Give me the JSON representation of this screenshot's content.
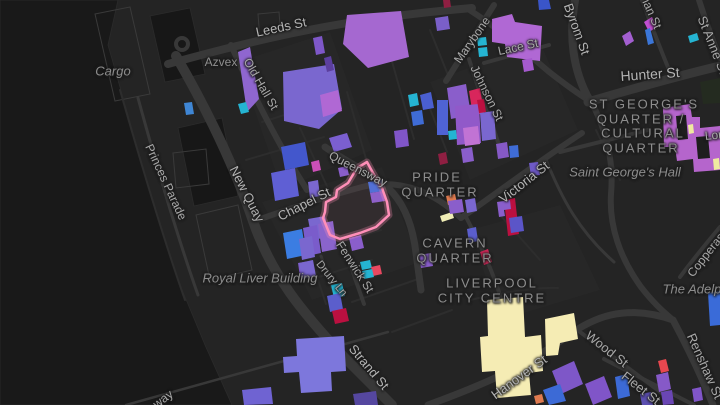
{
  "app": {
    "title": "Liverpool city centre dark map with highlighted parcel"
  },
  "map": {
    "width": 720,
    "height": 405,
    "palette": {
      "land": "#242424",
      "water": "#191919",
      "dock_water": "#171717",
      "block": "#272727",
      "road": "#383838",
      "minor_road": "#2d2d2d",
      "outline": "#3a3a3a",
      "park": "#242b20",
      "highlight_pink": "#ff8fb8",
      "building_purple": "#7a67cf",
      "building_magenta": "#b068d4",
      "building_blue": "#3f6cd6",
      "building_cyan": "#25b4d2",
      "building_crimson": "#bb1040",
      "building_cream": "#f5ecb4",
      "building_orange": "#e07b50"
    },
    "water_shapes": [
      {
        "pts": "0,0 118,0 108,45 128,115 152,200 178,280 205,345 232,405 0,405",
        "fill": "#191919"
      },
      {
        "pts": "178,128 222,118 238,196 194,206",
        "fill": "#171717"
      },
      {
        "pts": "150,16 190,8 205,74 165,82",
        "fill": "#171717"
      }
    ],
    "blocks": [
      {
        "pts": "238,62 330,32 372,150 282,190"
      },
      {
        "pts": "262,202 382,167 420,262 312,300"
      },
      {
        "pts": "430,82 540,42 578,130 470,180"
      },
      {
        "pts": "470,230 560,205 600,290 500,320"
      }
    ],
    "dock_outlines": [
      {
        "pts": "95,14 130,7 150,94 115,101"
      },
      {
        "pts": "196,215 238,205 252,270 210,280"
      },
      {
        "pts": "173,153 206,149 209,184 176,188"
      },
      {
        "pts": "258,14 279,12 281,38 260,40"
      }
    ],
    "roads": [
      {
        "d": "M 176,56 C 206,108 233,162 253,221 C 272,276 302,312 344,357 L 392,405",
        "w": 10
      },
      {
        "d": "M 168,64 C 262,38 342,19 472,8",
        "w": 8
      },
      {
        "d": "M 468,9 C 498,28 526,52 548,71 C 562,82 575,92 590,101",
        "w": 6
      },
      {
        "d": "M 575,0 C 569,34 572,70 590,101",
        "w": 8
      },
      {
        "d": "M 588,102 C 632,89 682,75 720,66",
        "w": 9
      },
      {
        "d": "M 592,103 C 606,131 614,160 611,194 C 609,226 620,258 641,287 C 655,305 664,312 673,320",
        "w": 6
      },
      {
        "d": "M 673,320 C 690,352 703,380 713,405",
        "w": 7
      },
      {
        "d": "M 428,405 C 472,389 522,369 566,337 C 592,318 624,303 673,320",
        "w": 7
      },
      {
        "d": "M 461,218 C 500,191 542,159 582,133",
        "w": 6
      },
      {
        "d": "M 252,222 C 302,204 332,195 362,187 C 402,177 436,194 461,218",
        "w": 6
      },
      {
        "d": "M 325,147 C 356,168 378,176 393,193 C 406,208 413,228 416,253 L 421,290",
        "w": 7
      },
      {
        "d": "M 231,45 C 252,92 272,132 296,172 L 307,190",
        "w": 6
      },
      {
        "d": "M 446,81 L 494,5",
        "w": 6
      },
      {
        "d": "M 469,59 C 477,85 485,108 494,130 L 500,148",
        "w": 4
      },
      {
        "d": "M 484,63 L 549,45",
        "w": 4
      },
      {
        "d": "M 699,0 C 707,25 714,44 720,58",
        "w": 6
      },
      {
        "d": "M 642,0 C 650,22 657,40 665,60 L 670,72",
        "w": 4
      },
      {
        "d": "M 690,146 L 720,128",
        "w": 5
      },
      {
        "d": "M 680,277 C 694,258 706,244 720,227",
        "w": 4
      },
      {
        "d": "M 341,238 L 364,304",
        "w": 4
      },
      {
        "d": "M 321,256 L 341,312",
        "w": 3
      },
      {
        "d": "M 568,323 L 667,397",
        "w": 4
      },
      {
        "d": "M 604,359 L 694,405",
        "w": 4
      },
      {
        "d": "M 466,217 C 482,248 494,274 502,302",
        "w": 4
      },
      {
        "d": "M 560,152 L 648,130",
        "w": 4
      },
      {
        "d": "M 545,157 C 562,200 580,232 614,262",
        "w": 3
      },
      {
        "d": "M 138,98 C 155,160 175,230 198,295",
        "w": 3
      },
      {
        "d": "M 126,405 L 388,332",
        "w": 2.5
      }
    ],
    "minor_roads": [
      {
        "d": "M 262,122 L 332,100"
      },
      {
        "d": "M 246,160 L 324,137"
      },
      {
        "d": "M 300,128 L 332,197"
      },
      {
        "d": "M 347,92 L 372,180"
      },
      {
        "d": "M 391,58 L 414,139"
      },
      {
        "d": "M 425,96 L 447,152"
      },
      {
        "d": "M 302,232 L 326,304"
      },
      {
        "d": "M 309,252 L 381,230"
      },
      {
        "d": "M 303,282 L 372,260"
      },
      {
        "d": "M 352,302 L 421,278"
      },
      {
        "d": "M 392,332 L 452,310"
      },
      {
        "d": "M 500,215 L 540,260"
      },
      {
        "d": "M 596,130 L 620,180"
      },
      {
        "d": "M 430,30 L 450,80"
      },
      {
        "d": "M 120,90 C 140,160 162,235 185,300"
      },
      {
        "d": "M 470,300 C 505,292 535,287 558,288"
      }
    ],
    "roundabouts": [
      {
        "cx": 182,
        "cy": 44,
        "r": 6
      }
    ],
    "park_shapes": [
      {
        "pts": "700,82 720,78 720,103 703,104"
      }
    ],
    "buildings": [
      {
        "pts": "347,15 401,11 409,57 368,68 343,44",
        "fill": "#a568d0"
      },
      {
        "pts": "283,72 334,64 342,109 319,129 284,121",
        "fill": "#7a67cf"
      },
      {
        "pts": "320,95 338,90 342,111 323,117",
        "fill": "#b068d4"
      },
      {
        "pts": "238,52 250,47 259,99 247,112",
        "fill": "#8f66cf"
      },
      {
        "pts": "238,104 246,102 249,112 241,114",
        "fill": "#25b4d2"
      },
      {
        "pts": "313,38 322,36 325,53 316,55",
        "fill": "#7e57c8"
      },
      {
        "pts": "324,58 331,56 334,70 327,72",
        "fill": "#5c3f9e"
      },
      {
        "pts": "411,112 422,110 424,124 413,126",
        "fill": "#3f6cd6"
      },
      {
        "pts": "408,95 417,93 419,105 410,107",
        "fill": "#25b4d2"
      },
      {
        "pts": "184,103 192,102 194,114 186,115",
        "fill": "#3f86d4"
      },
      {
        "pts": "492,19 512,14 515,22 542,26 540,61 507,57 505,44 492,42",
        "fill": "#b068d4"
      },
      {
        "pts": "435,18 448,16 450,29 437,31",
        "fill": "#7a5fc8"
      },
      {
        "pts": "477,38 486,37 487,45 478,46",
        "fill": "#25b4d2"
      },
      {
        "pts": "478,48 487,47 488,56 479,57",
        "fill": "#25b4d2"
      },
      {
        "pts": "522,60 532,58 534,70 524,72",
        "fill": "#a55ace"
      },
      {
        "pts": "538,0 549,0 551,9 539,10",
        "fill": "#3a55c8"
      },
      {
        "pts": "443,0 450,0 451,7 444,8",
        "fill": "#8f1f42"
      },
      {
        "pts": "469,91 480,88 484,113 473,116",
        "fill": "#d8265c"
      },
      {
        "pts": "447,88 466,84 471,115 451,119",
        "fill": "#8a5ecb"
      },
      {
        "pts": "420,95 431,92 434,108 423,110",
        "fill": "#4a5fd0"
      },
      {
        "pts": "644,22 652,17 657,27 649,32",
        "fill": "#c14fd0"
      },
      {
        "pts": "622,36 630,31 634,41 626,46",
        "fill": "#a35fd0"
      },
      {
        "pts": "645,30 650,28 654,43 648,45",
        "fill": "#3b76d8"
      },
      {
        "pts": "688,36 697,33 699,40 690,43",
        "fill": "#25b4d2"
      },
      {
        "pts": "663,108 690,104 692,117 700,117 700,128 720,126 720,170 694,172 693,159 677,161 675,147 664,147",
        "fill": "#b565cc"
      },
      {
        "pts": "676,116 686,115 688,139 678,140",
        "fill": "#1e1e1e"
      },
      {
        "pts": "696,137 708,136 710,158 698,159",
        "fill": "#1e1e1e"
      },
      {
        "pts": "688,125 693,124 694,133 689,134",
        "fill": "#efe9a0"
      },
      {
        "pts": "713,159 719,158 720,169 714,170",
        "fill": "#efe9a0"
      },
      {
        "pts": "437,100 448,100 448,135 437,135",
        "fill": "#4f63d4"
      },
      {
        "pts": "455,106 479,104 481,143 457,145",
        "fill": "#9159c9"
      },
      {
        "pts": "463,128 478,126 480,144 465,146",
        "fill": "#c173d4"
      },
      {
        "pts": "477,100 484,99 486,112 479,113",
        "fill": "#bb1040"
      },
      {
        "pts": "448,131 456,130 457,139 449,140",
        "fill": "#25b4d2"
      },
      {
        "pts": "438,154 446,152 448,163 440,165",
        "fill": "#8f1f42"
      },
      {
        "pts": "461,149 472,147 474,161 463,163",
        "fill": "#8a5ecb"
      },
      {
        "pts": "480,113 494,111 496,139 482,141",
        "fill": "#7a67cf"
      },
      {
        "pts": "504,200 515,198 519,234 508,236",
        "fill": "#bb1040"
      },
      {
        "pts": "446,196 455,194 457,203 448,205",
        "fill": "#e07b50"
      },
      {
        "pts": "440,216 452,212 454,218 442,222",
        "fill": "#f0edb5"
      },
      {
        "pts": "448,201 462,199 464,212 450,214",
        "fill": "#8a5ecb"
      },
      {
        "pts": "465,200 475,198 477,211 467,213",
        "fill": "#7a67cf"
      },
      {
        "pts": "509,146 518,145 519,157 510,158",
        "fill": "#3f6cd6"
      },
      {
        "pts": "496,144 507,142 509,157 498,159",
        "fill": "#8659c6"
      },
      {
        "pts": "529,163 538,162 540,175 531,176",
        "fill": "#6f5ac8"
      },
      {
        "pts": "497,202 510,200 511,209 504,210 505,216 499,217",
        "fill": "#8a5ecb"
      },
      {
        "pts": "509,218 522,216 524,231 511,233",
        "fill": "#5b55c8"
      },
      {
        "pts": "329,138 347,133 352,147 334,152",
        "fill": "#7b5fd0"
      },
      {
        "pts": "338,168 347,166 349,175 340,177",
        "fill": "#8a5ecb"
      },
      {
        "pts": "368,182 382,180 384,191 370,193",
        "fill": "#4a6fd9"
      },
      {
        "pts": "370,193 383,191 385,201 372,203",
        "fill": "#8a5ecb"
      },
      {
        "pts": "308,219 325,216 329,237 312,240",
        "fill": "#7a67cf"
      },
      {
        "pts": "308,182 318,180 320,196 310,198",
        "fill": "#7a67cf"
      },
      {
        "pts": "394,131 407,129 409,146 396,148",
        "fill": "#8055c8"
      },
      {
        "pts": "281,147 305,142 309,165 285,170",
        "fill": "#4357cc"
      },
      {
        "pts": "271,173 295,168 299,196 275,201",
        "fill": "#5f5fd4"
      },
      {
        "pts": "311,162 319,160 321,170 313,172",
        "fill": "#cc4fb8"
      },
      {
        "pts": "283,233 302,229 306,255 287,259",
        "fill": "#3b7de2"
      },
      {
        "pts": "303,228 317,225 321,253 307,256",
        "fill": "#7a5ccb"
      },
      {
        "pts": "318,224 333,221 337,249 322,252",
        "fill": "#8a64cc"
      },
      {
        "pts": "298,263 310,261 312,275 300,277",
        "fill": "#7e5ac8"
      },
      {
        "pts": "360,262 370,260 372,268 362,270",
        "fill": "#25b4d2"
      },
      {
        "pts": "371,267 380,265 382,274 373,276",
        "fill": "#e84860"
      },
      {
        "pts": "362,271 372,269 374,277 364,279",
        "fill": "#25b4d2"
      },
      {
        "pts": "331,285 342,283 345,296 334,298",
        "fill": "#25b4d2"
      },
      {
        "pts": "327,296 340,293 343,309 330,312",
        "fill": "#5b5ecc"
      },
      {
        "pts": "332,311 346,308 349,321 335,324",
        "fill": "#bb1040"
      },
      {
        "pts": "349,238 361,235 364,248 352,251",
        "fill": "#8a5ecb"
      },
      {
        "pts": "299,239 312,236 315,257 302,260",
        "fill": "#7a67cf"
      },
      {
        "pts": "299,263 313,260 316,276 302,279",
        "fill": "#7a67cf"
      },
      {
        "pts": "419,255 431,253 433,266 421,268",
        "fill": "#8a5ecb"
      },
      {
        "pts": "467,229 476,227 478,241 469,243",
        "fill": "#5b5ecc"
      },
      {
        "pts": "480,252 488,249 492,262 484,265",
        "fill": "#d02858"
      },
      {
        "pts": "296,339 344,336 346,371 331,372 332,391 301,393 299,372 284,373 283,357 297,356",
        "fill": "#7d77dc"
      },
      {
        "pts": "242,390 271,387 273,404 244,405",
        "fill": "#6f63d2"
      },
      {
        "pts": "353,394 376,391 378,405 355,405",
        "fill": "#55479f"
      },
      {
        "pts": "487,300 523,297 525,337 541,335 543,371 529,373 531,395 497,398 495,371 482,372 480,337 488,336",
        "fill": "#f5ecb4"
      },
      {
        "pts": "545,319 574,313 578,339 560,343 558,355 546,356",
        "fill": "#f5ecb4"
      },
      {
        "pts": "534,396 542,394 544,402 536,404",
        "fill": "#e07b50"
      },
      {
        "pts": "552,371 574,361 583,384 561,394",
        "fill": "#7e57c8"
      },
      {
        "pts": "543,390 560,384 566,401 549,405",
        "fill": "#3c6ad6"
      },
      {
        "pts": "585,384 604,376 612,397 593,405",
        "fill": "#8055c8"
      },
      {
        "pts": "708,293 720,291 720,325 710,326",
        "fill": "#3a6bd8"
      },
      {
        "pts": "658,361 666,359 669,371 661,373",
        "fill": "#e8474f"
      },
      {
        "pts": "656,375 668,372 671,389 659,392",
        "fill": "#8659c8"
      },
      {
        "pts": "615,377 627,374 630,396 618,399",
        "fill": "#3c6ad6"
      },
      {
        "pts": "661,392 672,390 674,404 663,405",
        "fill": "#6a46b4"
      },
      {
        "pts": "692,389 701,387 703,400 694,402",
        "fill": "#8055c8"
      },
      {
        "pts": "640,394 651,392 653,405 642,405",
        "fill": "#5c4fb0"
      }
    ],
    "highlight": {
      "pts": "367,162 357,168 348,183 337,190 336,197 326,202 325,212 323,218 330,235 340,239 360,233 376,227 389,215 387,202 382,188 373,173",
      "stroke": "#ff8fb8"
    },
    "labels": [
      {
        "text": "Leeds St",
        "x": 281,
        "y": 27,
        "rot": -12,
        "size": 13,
        "kind": "street-lg"
      },
      {
        "text": "Old Hall St",
        "x": 261,
        "y": 84,
        "rot": 60,
        "size": 12,
        "kind": "street"
      },
      {
        "text": "Azvex",
        "x": 221,
        "y": 62,
        "rot": 0,
        "size": 12,
        "kind": "poi"
      },
      {
        "text": "Cargo",
        "x": 113,
        "y": 71,
        "rot": 0,
        "size": 13,
        "kind": "poi-italic"
      },
      {
        "text": "Marybone",
        "x": 472,
        "y": 40,
        "rot": -55,
        "size": 12,
        "kind": "street"
      },
      {
        "text": "Lace St",
        "x": 518,
        "y": 47,
        "rot": -12,
        "size": 12,
        "kind": "street"
      },
      {
        "text": "Johnson St",
        "x": 487,
        "y": 93,
        "rot": 64,
        "size": 12,
        "kind": "street"
      },
      {
        "text": "Byrom St",
        "x": 577,
        "y": 29,
        "rot": 70,
        "size": 13,
        "kind": "street-lg"
      },
      {
        "text": "ian St",
        "x": 652,
        "y": 14,
        "rot": 66,
        "size": 12,
        "kind": "street"
      },
      {
        "text": "St Anne St",
        "x": 713,
        "y": 45,
        "rot": 68,
        "size": 13,
        "kind": "street"
      },
      {
        "text": "Hunter St",
        "x": 650,
        "y": 74,
        "rot": -4,
        "size": 14,
        "kind": "street-lg"
      },
      {
        "text": "London Rd",
        "x": 734,
        "y": 133,
        "rot": -6,
        "size": 12,
        "kind": "street"
      },
      {
        "text": "ST GEORGE'S",
        "x": 644,
        "y": 104,
        "rot": 0,
        "size": 13,
        "kind": "area"
      },
      {
        "text": "QUARTER /",
        "x": 641,
        "y": 119,
        "rot": 0,
        "size": 13,
        "kind": "area"
      },
      {
        "text": "CULTURAL",
        "x": 643,
        "y": 133,
        "rot": 0,
        "size": 13,
        "kind": "area"
      },
      {
        "text": "QUARTER",
        "x": 641,
        "y": 148,
        "rot": 0,
        "size": 13,
        "kind": "area"
      },
      {
        "text": "Saint George's Hall",
        "x": 625,
        "y": 172,
        "rot": 0,
        "size": 13,
        "kind": "poi-italic"
      },
      {
        "text": "Copperas Hill",
        "x": 712,
        "y": 247,
        "rot": -52,
        "size": 12,
        "kind": "street"
      },
      {
        "text": "Queensway",
        "x": 358,
        "y": 169,
        "rot": 27,
        "size": 12,
        "kind": "street"
      },
      {
        "text": "Chapel St",
        "x": 304,
        "y": 204,
        "rot": -27,
        "size": 13,
        "kind": "street-lg"
      },
      {
        "text": "New Quay",
        "x": 247,
        "y": 194,
        "rot": 63,
        "size": 13,
        "kind": "street-lg"
      },
      {
        "text": "Princes Parade",
        "x": 166,
        "y": 182,
        "rot": 65,
        "size": 12,
        "kind": "street"
      },
      {
        "text": "Royal Liver Building",
        "x": 260,
        "y": 278,
        "rot": 0,
        "size": 13,
        "kind": "poi-italic"
      },
      {
        "text": "Drury Ln",
        "x": 331,
        "y": 279,
        "rot": 51,
        "size": 11,
        "kind": "street"
      },
      {
        "text": "Fenwick St",
        "x": 355,
        "y": 267,
        "rot": 57,
        "size": 12,
        "kind": "street"
      },
      {
        "text": "Strand St",
        "x": 369,
        "y": 367,
        "rot": 50,
        "size": 13,
        "kind": "street-lg"
      },
      {
        "text": "CAVERN",
        "x": 455,
        "y": 243,
        "rot": 0,
        "size": 13,
        "kind": "area"
      },
      {
        "text": "QUARTER",
        "x": 455,
        "y": 258,
        "rot": 0,
        "size": 13,
        "kind": "area"
      },
      {
        "text": "LIVERPOOL",
        "x": 492,
        "y": 283,
        "rot": 0,
        "size": 13,
        "kind": "area"
      },
      {
        "text": "CITY CENTRE",
        "x": 492,
        "y": 298,
        "rot": 0,
        "size": 13,
        "kind": "area"
      },
      {
        "text": "PRIDE",
        "x": 437,
        "y": 177,
        "rot": 0,
        "size": 13,
        "kind": "area"
      },
      {
        "text": "QUARTER",
        "x": 440,
        "y": 192,
        "rot": 0,
        "size": 13,
        "kind": "area"
      },
      {
        "text": "Victoria St",
        "x": 524,
        "y": 182,
        "rot": -38,
        "size": 13,
        "kind": "street-lg"
      },
      {
        "text": "Hanover St",
        "x": 519,
        "y": 377,
        "rot": -36,
        "size": 13,
        "kind": "street-lg"
      },
      {
        "text": "Wood St",
        "x": 607,
        "y": 349,
        "rot": 38,
        "size": 13,
        "kind": "street"
      },
      {
        "text": "Fleet St",
        "x": 641,
        "y": 388,
        "rot": 38,
        "size": 13,
        "kind": "street"
      },
      {
        "text": "Renshaw St",
        "x": 705,
        "y": 366,
        "rot": 66,
        "size": 13,
        "kind": "street"
      },
      {
        "text": "The Adelphi",
        "x": 697,
        "y": 289,
        "rot": 0,
        "size": 13,
        "kind": "poi-italic"
      },
      {
        "text": "way",
        "x": 163,
        "y": 399,
        "rot": -37,
        "size": 12,
        "kind": "street"
      }
    ]
  }
}
